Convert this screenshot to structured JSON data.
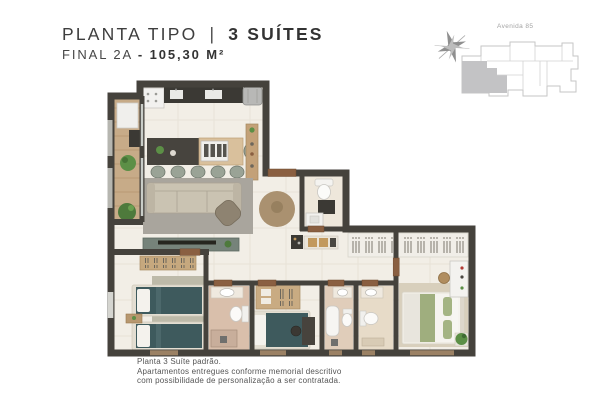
{
  "header": {
    "title_regular": "PLANTA TIPO",
    "title_divider": "|",
    "title_bold": "3 SUÍTES",
    "subtitle_regular": "FINAL 2A",
    "subtitle_bold": "- 105,30 M²"
  },
  "site_plan": {
    "street_label": "Avenida 85",
    "highlight_note": "unit-2A-highlighted"
  },
  "footnote": {
    "line1": "Planta 3 Suíte padrão.",
    "line2": "Apartamentos entregues conforme memorial descritivo",
    "line3": "com possibilidade de personalização a ser contratada."
  },
  "palette": {
    "wall": "#45423c",
    "floor": "#f2eee6",
    "balcony_wood": "#c7ab88",
    "island_wood": "#d9c09c",
    "counter_dark": "#3b3934",
    "rug_gray": "#a9a59d",
    "sofa_beige": "#cac3b2",
    "tv_console_sage": "#76837a",
    "bed_teal": "#3e5a5d",
    "master_green": "#9fae7e",
    "bath_terracotta": "#d9bfab",
    "round_rug_tan": "#aa9170",
    "door_brown": "#8a5f41",
    "keyplan_gray": "#c3c3c5",
    "text_dark": "#3e3e3e",
    "text_gray": "#555555"
  }
}
